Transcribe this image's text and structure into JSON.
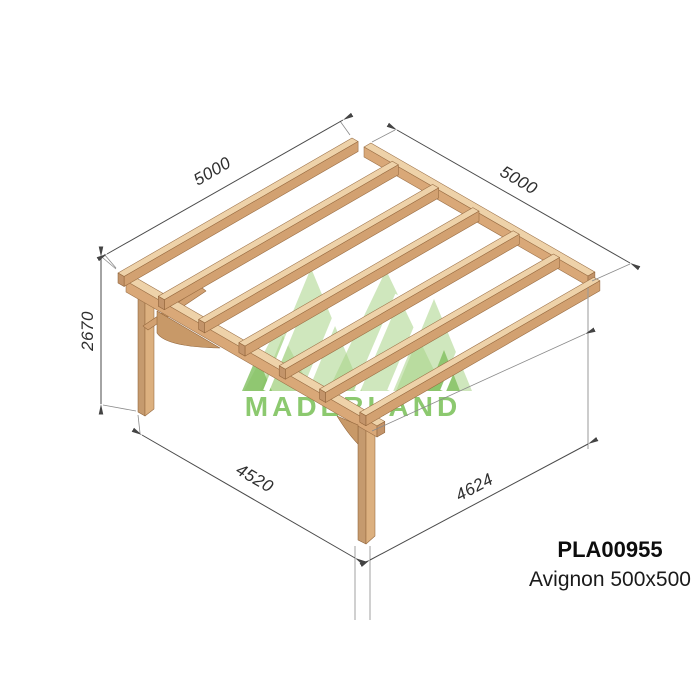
{
  "product": {
    "code": "PLA00955",
    "name": "Avignon 500x500"
  },
  "brand": {
    "name": "MADERLAND"
  },
  "dimensions": {
    "rafter_length": "5000",
    "ledger_length": "5000",
    "height": "2670",
    "front_span": "4520",
    "side_span": "4624"
  },
  "colors": {
    "wood_light": "#eed2a9",
    "wood_medium": "#d9a878",
    "wood_dark": "#c3946a",
    "logo_green": "#8cc96f",
    "logo_tree_green": "#a8d487",
    "dimension_line": "#4a4a4a",
    "label_text": "#0d0d0d"
  }
}
